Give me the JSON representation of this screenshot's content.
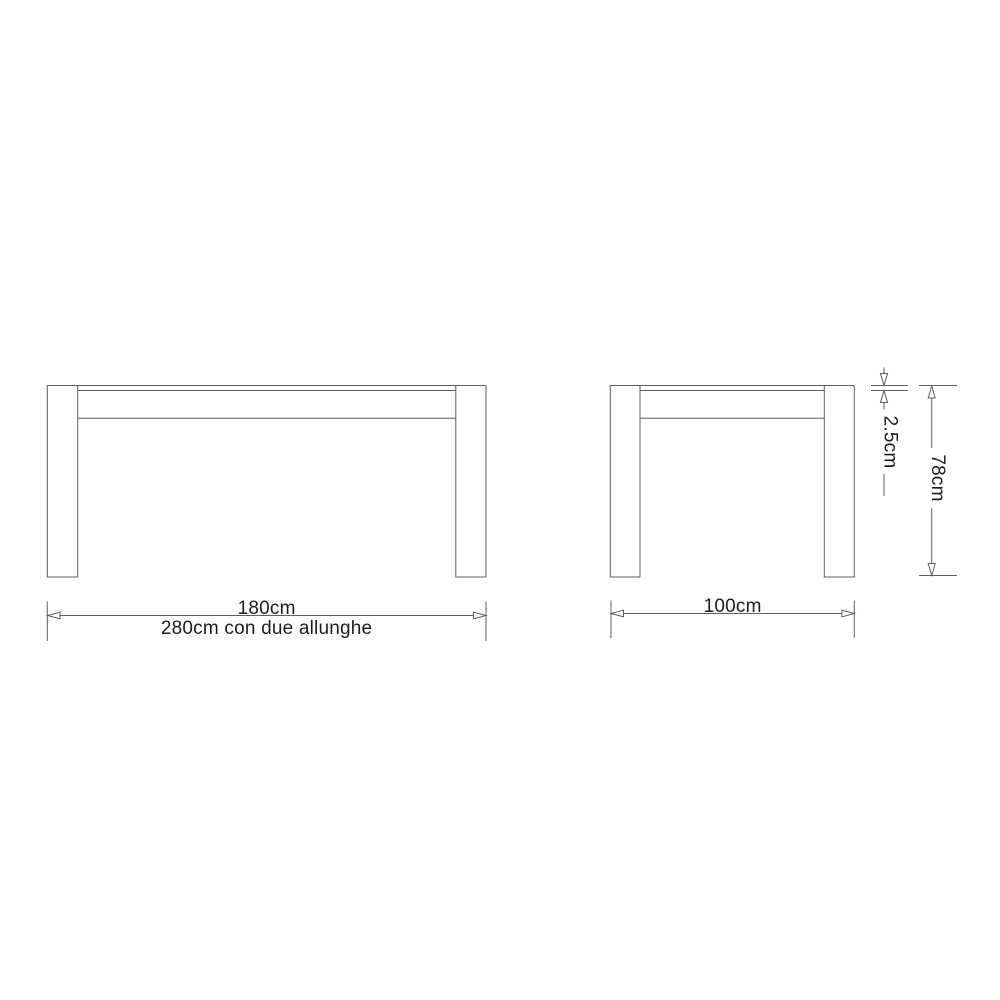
{
  "colors": {
    "background": "#ffffff",
    "line": "#5f5f5f",
    "text": "#1c1c1c"
  },
  "drawing": {
    "kind": "technical dimension drawing",
    "subject": "extendable table, front and side elevations",
    "dimensions": {
      "front_width": {
        "primary": "180cm",
        "secondary": "280cm con due allunghe",
        "value_cm": 180,
        "extended_value_cm": 280
      },
      "side_width": {
        "value": "100cm",
        "value_cm": 100
      },
      "top_thickness": {
        "value": "2.5cm",
        "value_cm": 2.5
      },
      "height": {
        "value": "78cm",
        "value_cm": 78
      }
    }
  }
}
